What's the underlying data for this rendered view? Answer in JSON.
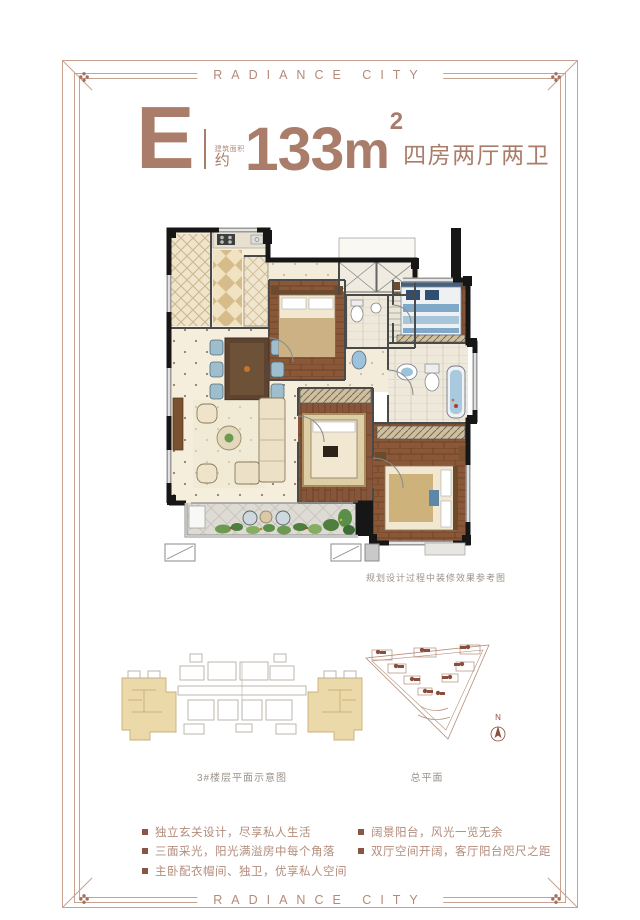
{
  "header": {
    "brand": "RADIANCE CITY"
  },
  "footer": {
    "brand": "RADIANCE CITY"
  },
  "unit": {
    "letter": "E",
    "area_label_small": "建筑面积",
    "area_prefix": "约",
    "area_value": "133",
    "area_unit": "m",
    "area_exponent": "2",
    "rooms": "四房两厅两卫"
  },
  "floorplan": {
    "caption": "规划设计过程中装修效果参考图"
  },
  "diagrams": {
    "building": {
      "caption": "3#楼层平面示意图"
    },
    "site": {
      "caption": "总平面",
      "north_label": "N"
    }
  },
  "features": {
    "left": [
      "独立玄关设计，尽享私人生活",
      "三面采光，阳光满溢房中每个角落",
      "主卧配衣帽间、独卫，优享私人空间"
    ],
    "right": [
      "阔景阳台，风光一览无余",
      "双厅空间开阔，客厅阳台咫尺之距"
    ]
  },
  "colors": {
    "accent_brown": "#aa7c6a",
    "frame_line": "#c9a18f",
    "brand_text": "#b5897a",
    "bullet_square": "#8a5644",
    "feature_text": "#b38c7b",
    "caption_gray": "#9c9189",
    "plan_wall": "#161616",
    "plan_cream_floor": "#f6eedd",
    "plan_wood_floor": "#8a5838",
    "plan_highlight_tan": "#ecd9a9",
    "site_outline": "#b48e7a"
  }
}
